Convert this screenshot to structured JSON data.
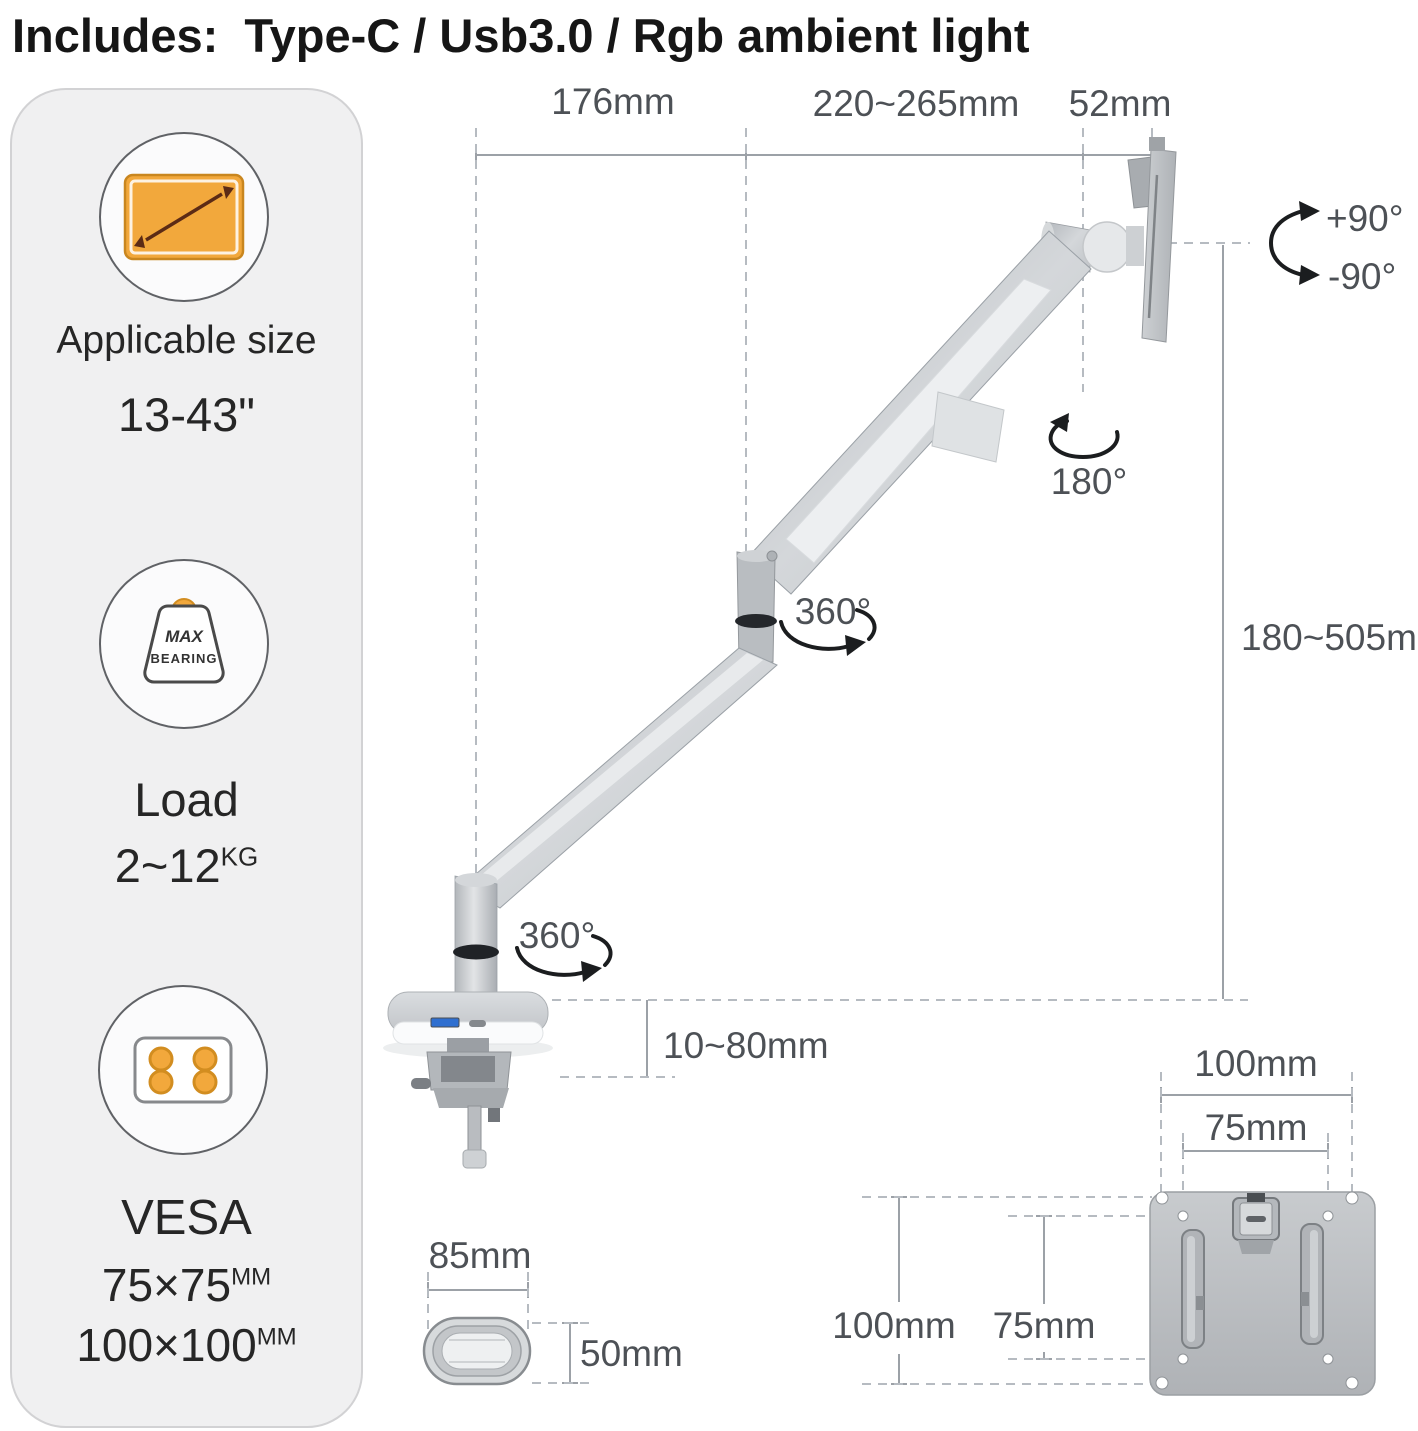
{
  "title": "Includes:  Type-C / Usb3.0 / Rgb ambient light",
  "sidebar": {
    "applicable_size": {
      "label": "Applicable size",
      "value": "13-43\""
    },
    "load": {
      "label": "Load",
      "value": "2~12",
      "unit": "KG",
      "icon_line1": "MAX",
      "icon_line2": "BEARING"
    },
    "vesa": {
      "label": "VESA",
      "value1": "75×75",
      "unit1": "MM",
      "value2": "100×100",
      "unit2": "MM"
    }
  },
  "dimensions": {
    "arm_reach": "176mm",
    "arm_extension": "220~265mm",
    "plate_offset": "52mm",
    "tilt_up": "+90°",
    "tilt_down": "-90°",
    "swivel": "180°",
    "rotate_upper": "360°",
    "rotate_lower": "360°",
    "height_range": "180~505mm",
    "clamp_thickness": "10~80mm",
    "base_width": "85mm",
    "base_depth": "50mm",
    "vesa_width_outer": "100mm",
    "vesa_width_inner": "75mm",
    "vesa_height_outer": "100mm",
    "vesa_height_inner": "75mm"
  },
  "colors": {
    "accent_orange": "#F2A83C",
    "accent_orange_dark": "#D28D20",
    "panel_bg": "#F0F0F1",
    "metal_gray": "#C6CACD",
    "dim_line": "#9CA1A7",
    "dim_text": "#4D5156",
    "arrow_black": "#1B1D1F"
  }
}
